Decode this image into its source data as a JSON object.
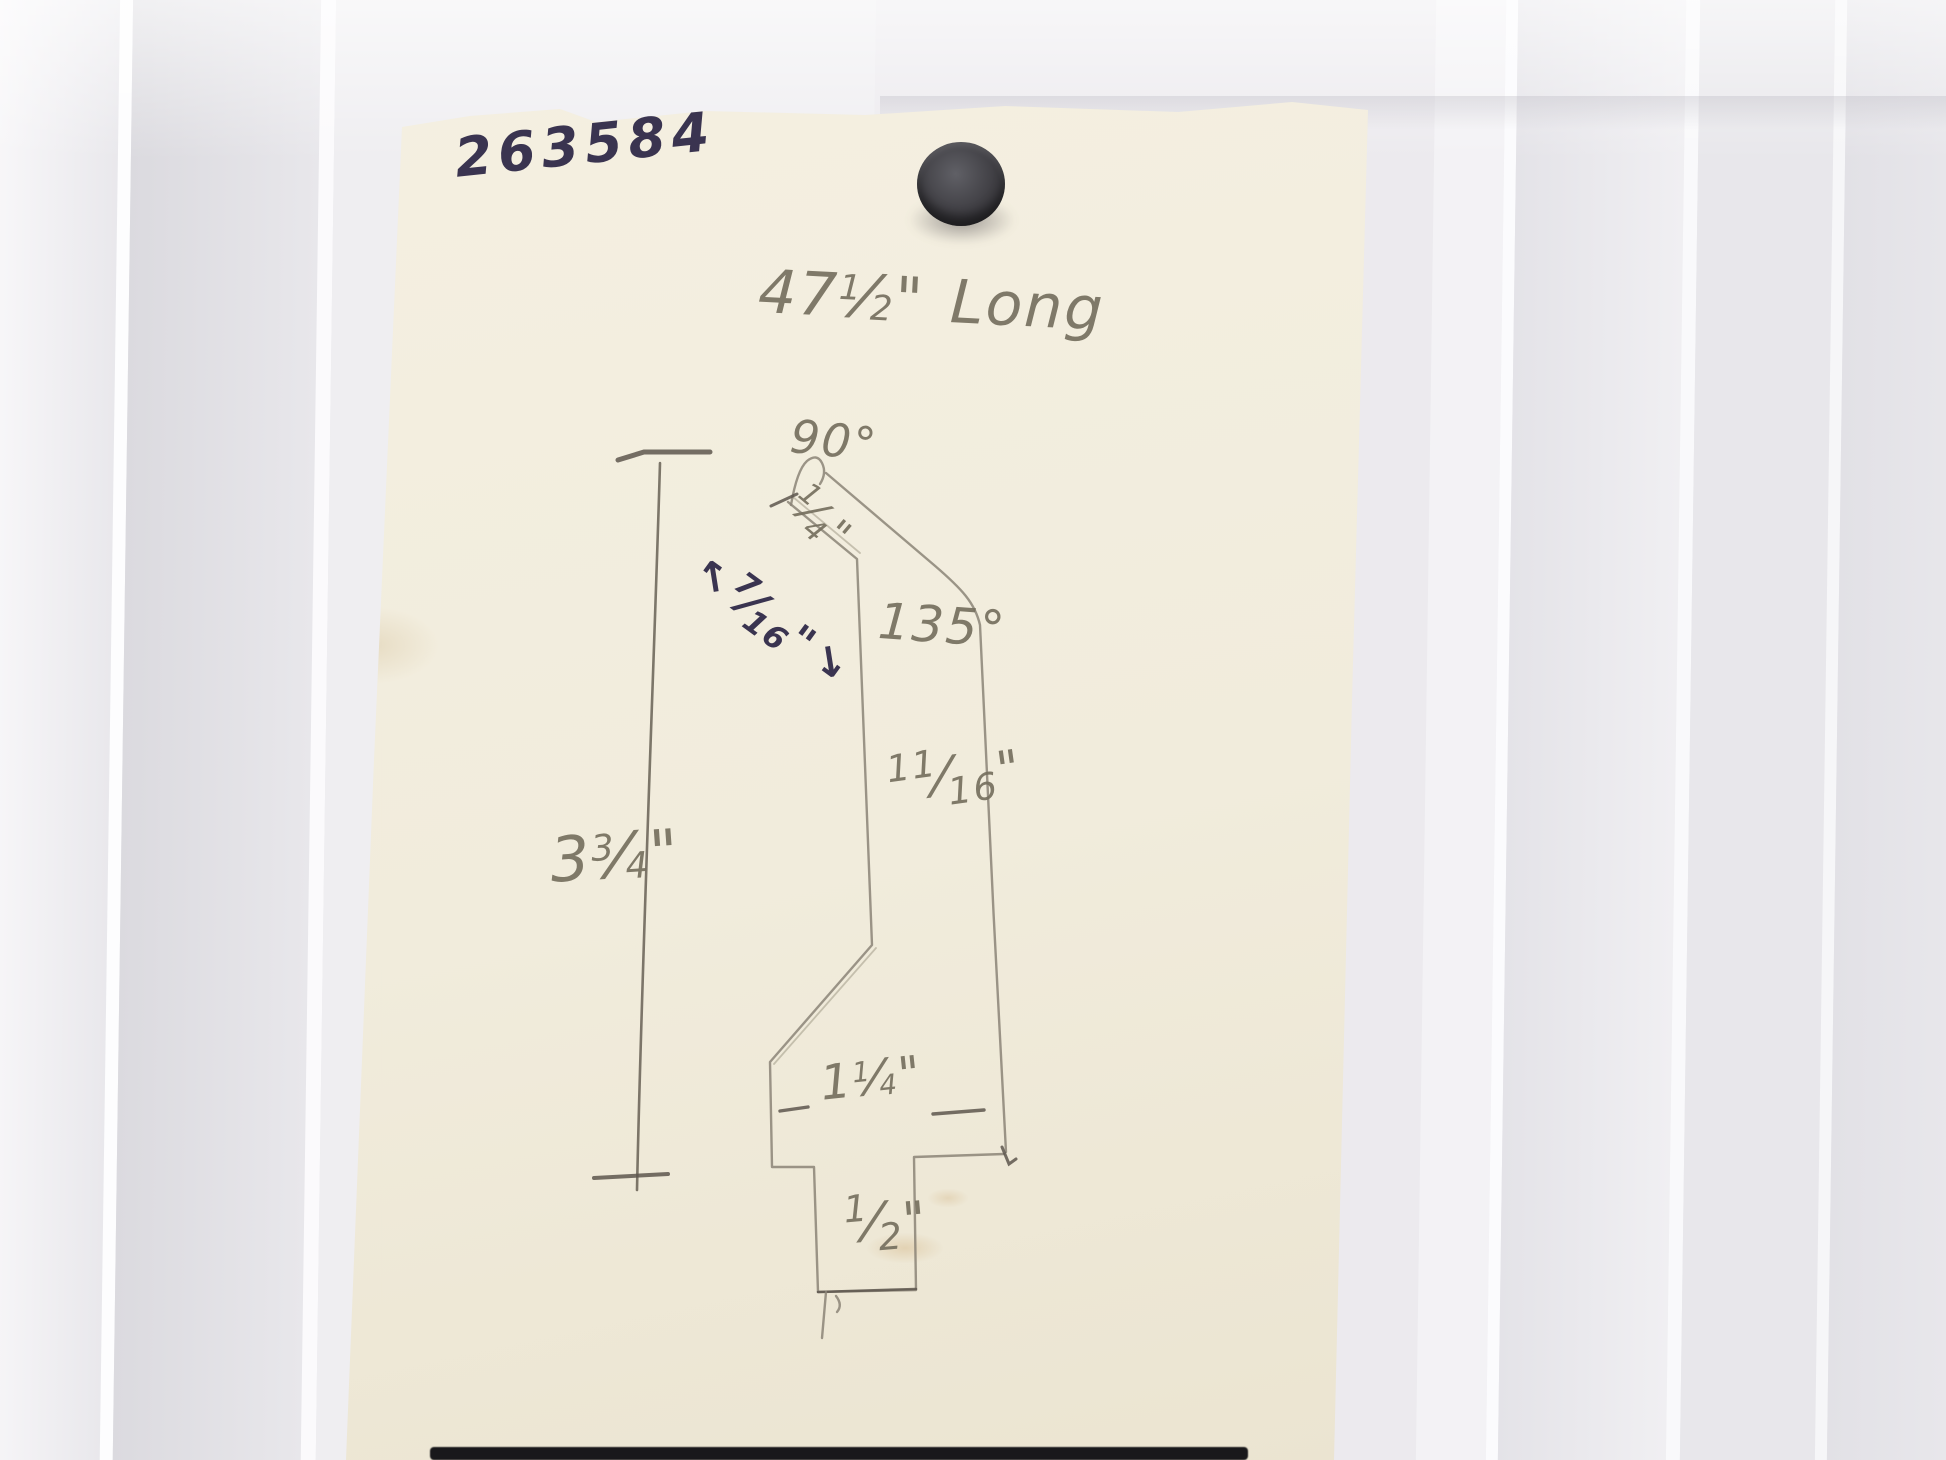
{
  "photo": {
    "labels": {
      "slash": "⁄",
      "part_number": "263584",
      "length": {
        "whole": "47",
        "num": "1",
        "den": "2",
        "unit": "\"",
        "suffix": "Long"
      },
      "angle_top": "90°",
      "thickness_top": {
        "num": "1",
        "den": "4",
        "unit": "\""
      },
      "flange": {
        "arrow_left": "↖",
        "num": "7",
        "den": "16",
        "unit": "\"",
        "arrow_right": "↘"
      },
      "angle_bend": "135°",
      "side": {
        "num": "11",
        "den": "16",
        "unit": "\""
      },
      "height": {
        "whole": "3",
        "num": "3",
        "den": "4",
        "unit": "\""
      },
      "base_width": {
        "whole": "1",
        "num": "1",
        "den": "4",
        "unit": "\""
      },
      "tab": {
        "num": "1",
        "den": "2",
        "unit": "\""
      }
    },
    "colors": {
      "pencil": "#76705f",
      "ink": "#3a3450",
      "paper": "#f1ecdc",
      "magnet": "#3f3e43",
      "wall": "#e9e8ec"
    }
  }
}
